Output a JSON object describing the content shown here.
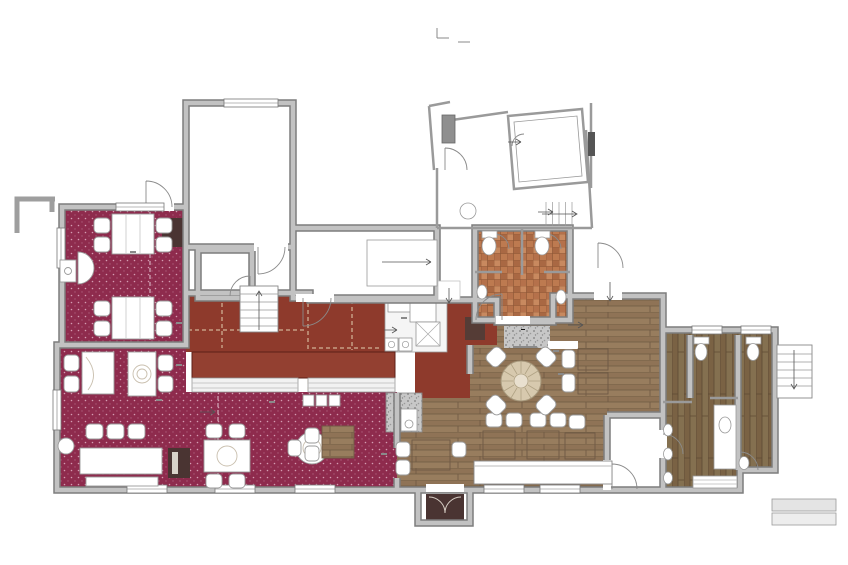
{
  "colors": {
    "carpet": "#8e2b4d",
    "bar_floor": "#8e3a2c",
    "counter": "#934031",
    "wood": "#8f7458",
    "tile": "#b9744c",
    "wall": "#b5b5b5",
    "tv_highlight": "#ffe400",
    "dark_room": "#4a3432"
  },
  "icons": {
    "arrow_right": "→",
    "arrow_up": "↑",
    "arrow_down": "↓"
  },
  "yards": {
    "left": "External yard",
    "center": "External yard"
  },
  "outbuildings": {
    "title": "Outbuildings",
    "subtitle": "(not surveyed)"
  },
  "rooms": {
    "kitchen": "Kitchen",
    "freezer": "Freezer",
    "kitchen_store": "Kitchen store",
    "beer_cellar": "Beer Cellar",
    "cupd": "Cup'd",
    "ladies": "Ladies",
    "store": "Store",
    "gents": "Gents",
    "wc": "W.C.",
    "restaurant_rear": {
      "name": "Restaurant (rear)",
      "covers": "COVERS 9"
    },
    "restaurant": {
      "name": "Restaurant",
      "covers": "COVERS 16"
    },
    "bar_area": {
      "name": "Bar",
      "covers": "COVERS 14"
    },
    "lounge": {
      "name": "Lounge",
      "name2": "/Bar",
      "covers": "COVERS 15"
    },
    "bar_counter_left": "Bar",
    "bar_counter_mid": "Bar",
    "bar_servery": "Bar"
  },
  "levels": {
    "up110_freezer": {
      "l1": "Up",
      "l2": "110"
    },
    "up605": {
      "l1": "Up",
      "l2": "605"
    },
    "ramp": {
      "l1": "ramp up",
      "l2": "300"
    },
    "dn170": {
      "l1": "Dn",
      "l2": "170"
    },
    "up240": {
      "l1": "Up",
      "l2": "240"
    },
    "up_cupd_stairs": "Up",
    "up110_rear": {
      "l1": "Up",
      "l2": "110"
    },
    "up120": {
      "l1": "Up",
      "l2": "120"
    },
    "up100": {
      "l1": "Up",
      "l2": "100"
    },
    "up250": {
      "l1": "Up",
      "l2": "250"
    },
    "up350": {
      "l1": "Up",
      "l2": "350"
    },
    "up110_restaurant": {
      "l1": "Up",
      "l2": "110"
    },
    "up285": {
      "l1": "Up",
      "l2": "285"
    },
    "up165_corridor": {
      "l1": "Up",
      "l2": "165"
    },
    "up165_lounge": {
      "l1": "Up",
      "l2": "165"
    },
    "up_external": "Up"
  },
  "fixtures": {
    "wood_burner": {
      "l1": "Wood",
      "l2": "burner"
    },
    "racking": "racking",
    "worktop": {
      "l1": "s/s",
      "l2": "worktop"
    },
    "ref": "ref g/w",
    "sinks": "sinks",
    "open_hearth": {
      "l1": "open",
      "l2": "hearth"
    },
    "tv": "TV",
    "darts_upper": "darts",
    "darts_lower": "darts",
    "fixed_seating": "new fixed seating"
  }
}
